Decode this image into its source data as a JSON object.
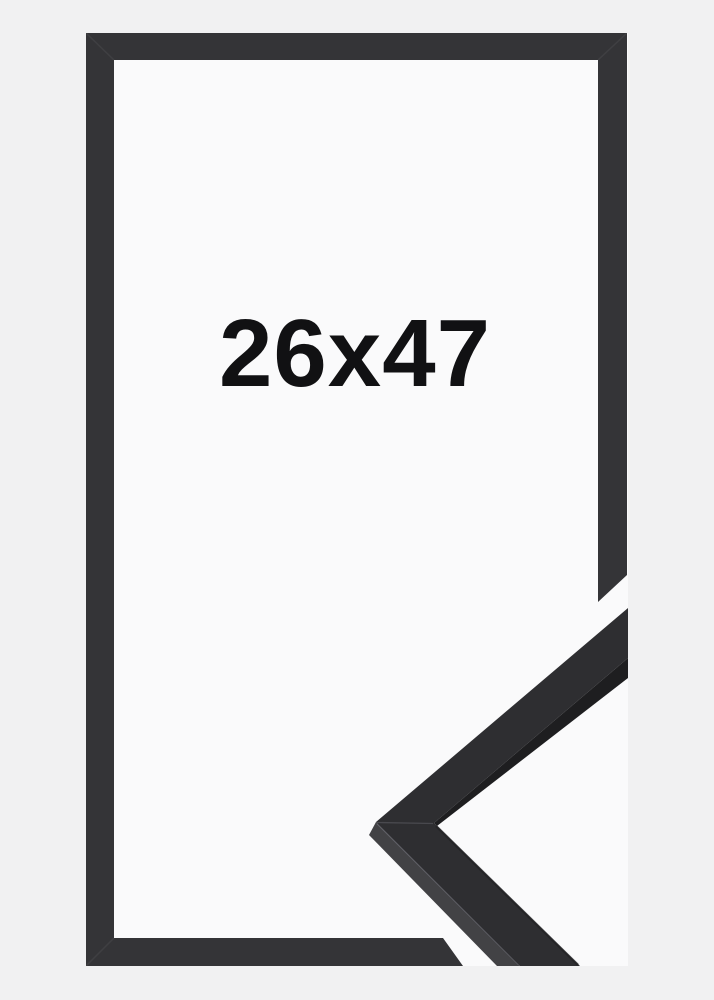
{
  "product": {
    "size_label": "26x47",
    "description": "black picture frame mockup with moulding corner sample"
  },
  "colors": {
    "page_background": "#f1f1f2",
    "photo_background": "#fafafb",
    "frame": "#343437",
    "sample_top_face": "#2e2e31",
    "sample_side_face": "#424245",
    "sample_edge_shadow": "#1e1e20",
    "label_text": "#111113"
  }
}
